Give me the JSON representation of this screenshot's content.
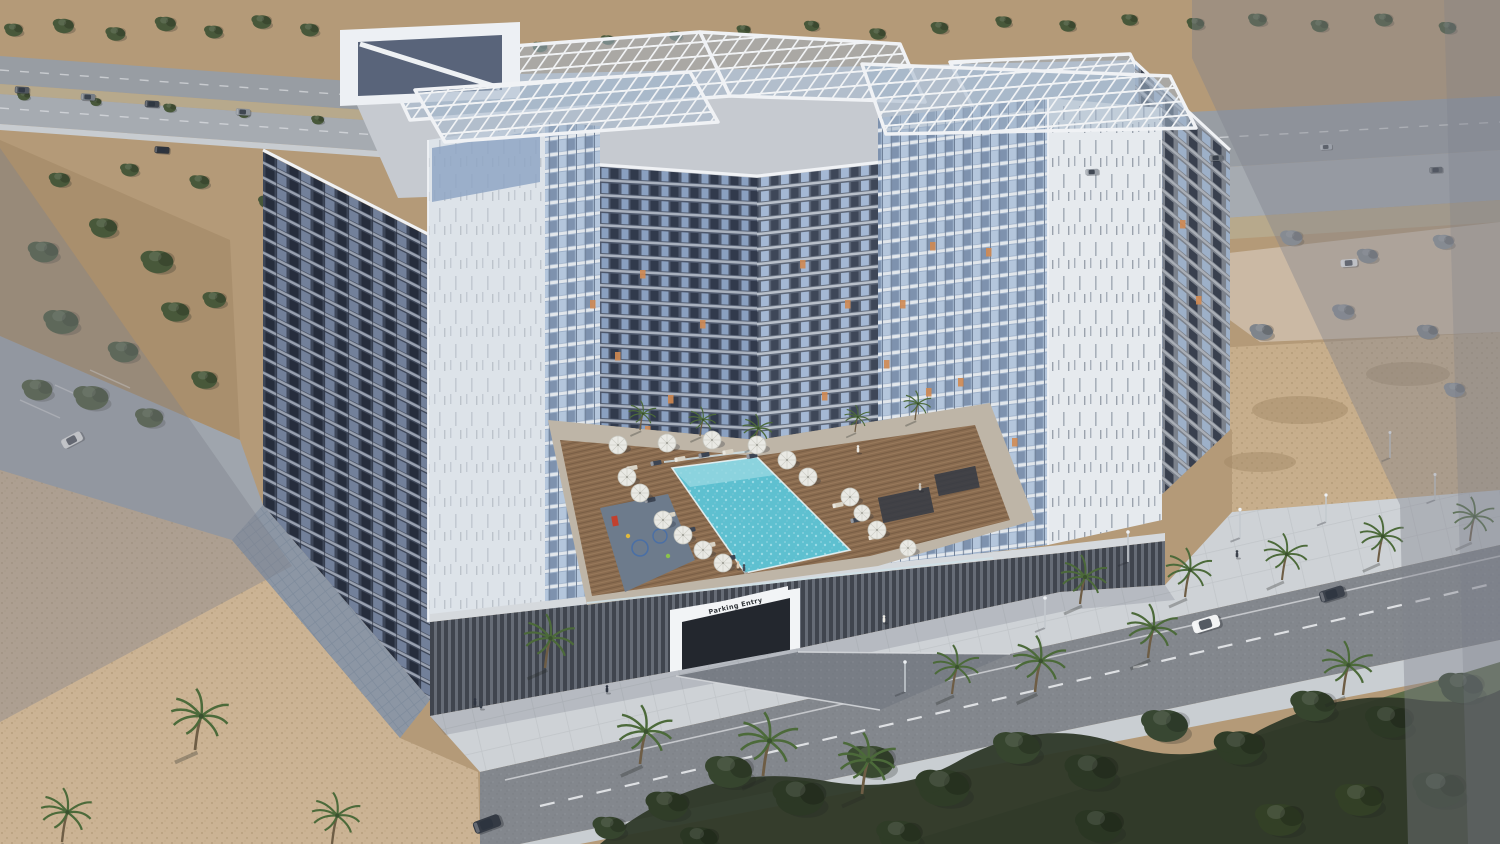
{
  "scene": {
    "type": "aerial architectural rendering",
    "setting": "U-shaped residential apartment complex with rooftop pergolas and a central pool courtyard, in a desert city with palm-lined streets",
    "labels": {
      "parking_sign": "Parking Entry"
    },
    "colors": {
      "dirt": "#b49a78",
      "dirtDark": "#a98f6d",
      "roadTop": "#989da3",
      "roadTop2": "#a6abb1",
      "median": "#b7a98c",
      "plaza": "#cbb9a4",
      "parkingLot": "#9fa5ad",
      "sandLeft": "#cbb394",
      "sandRight": "#c7ae8c",
      "sandStreak": "#a08764",
      "sidewalk": "#ced2d6",
      "stripWalk": "#c9ced2",
      "road": "#83878d",
      "laneLine": "#e8eaec",
      "grass": "#5c6d49",
      "foliage": "#2e3828",
      "poolWater": "#5ec0d0",
      "poolLight": "#93d6e0",
      "deckWood": "#8a6c50",
      "walkway": "#beb5a7",
      "playground": "#6d7b8c",
      "fence": "#cfe0e8",
      "louver": "#40454e",
      "coping": "#d5d9dd",
      "driveway": "#787d85",
      "tiledWalk": "#aab6c2",
      "towerWhite": "#dde3e9",
      "whitePanel": "#e6eaee",
      "roofSlab": "#c6cad0",
      "pergolaGlass": "#a3b4c8",
      "parapet": "#f0f2f5",
      "penthouseGlass": "#8fa6c4",
      "portalInner": "#59647a",
      "signBg": "#f2f4f6",
      "signText": "#2f3338",
      "entryDark": "#23272e",
      "treeGreen": "#48583a",
      "palmGreen": "#4c6a3a",
      "palmTrunk": "#6e5d45",
      "litWindow": "#d08a52",
      "overlay": "rgba(127,131,141,0.40)",
      "overlayEdge": "rgba(120,124,134,0.25)"
    }
  },
  "instances": {
    "bgTrees": [
      {
        "x": 14,
        "y": 30,
        "s": 0.8
      },
      {
        "x": 64,
        "y": 26,
        "s": 0.9
      },
      {
        "x": 116,
        "y": 34,
        "s": 0.85
      },
      {
        "x": 166,
        "y": 24,
        "s": 0.9
      },
      {
        "x": 214,
        "y": 32,
        "s": 0.8
      },
      {
        "x": 262,
        "y": 22,
        "s": 0.85
      },
      {
        "x": 310,
        "y": 30,
        "s": 0.8
      },
      {
        "x": 356,
        "y": 40,
        "s": 0.7
      },
      {
        "x": 404,
        "y": 46,
        "s": 0.75
      },
      {
        "x": 470,
        "y": 52,
        "s": 0.7
      },
      {
        "x": 540,
        "y": 47,
        "s": 0.65
      },
      {
        "x": 608,
        "y": 40,
        "s": 0.6
      },
      {
        "x": 676,
        "y": 36,
        "s": 0.6
      },
      {
        "x": 744,
        "y": 30,
        "s": 0.6
      },
      {
        "x": 812,
        "y": 26,
        "s": 0.65
      },
      {
        "x": 878,
        "y": 34,
        "s": 0.7
      },
      {
        "x": 940,
        "y": 28,
        "s": 0.75
      },
      {
        "x": 1004,
        "y": 22,
        "s": 0.7
      },
      {
        "x": 1068,
        "y": 26,
        "s": 0.7
      },
      {
        "x": 1130,
        "y": 20,
        "s": 0.7
      },
      {
        "x": 1196,
        "y": 24,
        "s": 0.75
      },
      {
        "x": 1258,
        "y": 20,
        "s": 0.8
      },
      {
        "x": 1320,
        "y": 26,
        "s": 0.75
      },
      {
        "x": 1384,
        "y": 20,
        "s": 0.8
      },
      {
        "x": 1448,
        "y": 28,
        "s": 0.75
      },
      {
        "x": 24,
        "y": 96,
        "s": 0.55
      },
      {
        "x": 96,
        "y": 102,
        "s": 0.5
      },
      {
        "x": 170,
        "y": 108,
        "s": 0.55
      },
      {
        "x": 244,
        "y": 114,
        "s": 0.5
      },
      {
        "x": 318,
        "y": 120,
        "s": 0.55
      },
      {
        "x": 392,
        "y": 126,
        "s": 0.5
      },
      {
        "x": 466,
        "y": 132,
        "s": 0.5
      },
      {
        "x": 44,
        "y": 252,
        "s": 1.3
      },
      {
        "x": 104,
        "y": 228,
        "s": 1.2
      },
      {
        "x": 158,
        "y": 262,
        "s": 1.4
      },
      {
        "x": 62,
        "y": 322,
        "s": 1.5
      },
      {
        "x": 124,
        "y": 352,
        "s": 1.3
      },
      {
        "x": 176,
        "y": 312,
        "s": 1.2
      },
      {
        "x": 92,
        "y": 398,
        "s": 1.5
      },
      {
        "x": 38,
        "y": 390,
        "s": 1.3
      },
      {
        "x": 150,
        "y": 418,
        "s": 1.2
      },
      {
        "x": 205,
        "y": 380,
        "s": 1.1
      },
      {
        "x": 215,
        "y": 300,
        "s": 1.0
      },
      {
        "x": 60,
        "y": 180,
        "s": 0.9
      },
      {
        "x": 130,
        "y": 170,
        "s": 0.8
      },
      {
        "x": 200,
        "y": 182,
        "s": 0.85
      },
      {
        "x": 268,
        "y": 202,
        "s": 0.8
      },
      {
        "x": 935,
        "y": 186,
        "s": 0.9,
        "c": "#6e7a62"
      },
      {
        "x": 1008,
        "y": 176,
        "s": 0.95,
        "c": "#67735c"
      },
      {
        "x": 1086,
        "y": 190,
        "s": 0.85,
        "c": "#6e7a62"
      },
      {
        "x": 520,
        "y": 130,
        "s": 0.6
      },
      {
        "x": 596,
        "y": 140,
        "s": 0.55
      },
      {
        "x": 660,
        "y": 150,
        "s": 0.5
      }
    ],
    "grayTrees": [
      {
        "x": 1215,
        "y": 252,
        "s": 0.9,
        "c": "#848a90"
      },
      {
        "x": 1292,
        "y": 238,
        "s": 0.95,
        "c": "#8b9197"
      },
      {
        "x": 1368,
        "y": 256,
        "s": 0.9,
        "c": "#848a90"
      },
      {
        "x": 1444,
        "y": 242,
        "s": 0.9,
        "c": "#8b9197"
      },
      {
        "x": 1262,
        "y": 332,
        "s": 1.0,
        "c": "#7f858c"
      },
      {
        "x": 1344,
        "y": 312,
        "s": 0.95,
        "c": "#878d94"
      },
      {
        "x": 1428,
        "y": 332,
        "s": 0.9,
        "c": "#7f858c"
      },
      {
        "x": 1180,
        "y": 300,
        "s": 0.85,
        "c": "#878d94"
      },
      {
        "x": 1455,
        "y": 390,
        "s": 0.9,
        "c": "#8a9096"
      }
    ],
    "foliageTrees": [
      {
        "x": 668,
        "y": 806,
        "s": 1.8,
        "c": "#303d28"
      },
      {
        "x": 730,
        "y": 772,
        "s": 2.0,
        "c": "#36452e"
      },
      {
        "x": 800,
        "y": 798,
        "s": 2.2,
        "c": "#2c3825"
      },
      {
        "x": 872,
        "y": 762,
        "s": 2.0,
        "c": "#3a4a31"
      },
      {
        "x": 944,
        "y": 788,
        "s": 2.3,
        "c": "#2f3c27"
      },
      {
        "x": 1018,
        "y": 748,
        "s": 2.0,
        "c": "#36452e"
      },
      {
        "x": 1092,
        "y": 772,
        "s": 2.2,
        "c": "#2c3825"
      },
      {
        "x": 1166,
        "y": 726,
        "s": 2.0,
        "c": "#384732"
      },
      {
        "x": 1240,
        "y": 748,
        "s": 2.1,
        "c": "#2f3c27"
      },
      {
        "x": 1314,
        "y": 706,
        "s": 1.9,
        "c": "#36452e"
      },
      {
        "x": 1390,
        "y": 722,
        "s": 2.0,
        "c": "#2c3825"
      },
      {
        "x": 1462,
        "y": 688,
        "s": 1.9,
        "c": "#384732"
      },
      {
        "x": 1440,
        "y": 790,
        "s": 2.2,
        "c": "#2a3623"
      },
      {
        "x": 1360,
        "y": 800,
        "s": 2.0,
        "c": "#334026"
      },
      {
        "x": 700,
        "y": 840,
        "s": 1.6,
        "c": "#2a3623"
      },
      {
        "x": 900,
        "y": 836,
        "s": 1.9,
        "c": "#2f3c27"
      },
      {
        "x": 1100,
        "y": 826,
        "s": 2.0,
        "c": "#2a3623"
      },
      {
        "x": 1280,
        "y": 820,
        "s": 2.0,
        "c": "#334026"
      },
      {
        "x": 610,
        "y": 828,
        "s": 1.4,
        "c": "#36452e"
      }
    ],
    "palms": [
      {
        "x": 545,
        "y": 668,
        "s": 1.1
      },
      {
        "x": 195,
        "y": 750,
        "s": 1.25
      },
      {
        "x": 62,
        "y": 842,
        "s": 1.1
      },
      {
        "x": 332,
        "y": 844,
        "s": 1.05
      },
      {
        "x": 640,
        "y": 764,
        "s": 1.2
      },
      {
        "x": 1080,
        "y": 604,
        "s": 1.0
      },
      {
        "x": 1185,
        "y": 597,
        "s": 1.0
      },
      {
        "x": 1282,
        "y": 580,
        "s": 0.95
      },
      {
        "x": 1378,
        "y": 562,
        "s": 0.95
      },
      {
        "x": 1470,
        "y": 541,
        "s": 0.9
      },
      {
        "x": 1035,
        "y": 692,
        "s": 1.15
      },
      {
        "x": 1148,
        "y": 658,
        "s": 1.1
      },
      {
        "x": 952,
        "y": 694,
        "s": 1.0
      },
      {
        "x": 763,
        "y": 776,
        "s": 1.3
      },
      {
        "x": 862,
        "y": 794,
        "s": 1.25
      },
      {
        "x": 1343,
        "y": 695,
        "s": 1.1
      }
    ],
    "courtPalms": [
      {
        "x": 640,
        "y": 430,
        "s": 0.6
      },
      {
        "x": 700,
        "y": 436,
        "s": 0.6
      },
      {
        "x": 755,
        "y": 446,
        "s": 0.65
      },
      {
        "x": 915,
        "y": 420,
        "s": 0.6
      },
      {
        "x": 855,
        "y": 432,
        "s": 0.55
      }
    ],
    "poles": [
      {
        "x": 1045,
        "y": 628,
        "s": 1
      },
      {
        "x": 1128,
        "y": 562,
        "s": 1
      },
      {
        "x": 1240,
        "y": 538,
        "s": 0.95
      },
      {
        "x": 1326,
        "y": 522,
        "s": 0.9
      },
      {
        "x": 1390,
        "y": 458,
        "s": 0.85
      },
      {
        "x": 905,
        "y": 692,
        "s": 1
      },
      {
        "x": 1435,
        "y": 500,
        "s": 0.85
      }
    ],
    "cars": [
      {
        "x": 1206,
        "y": 624,
        "r": -17,
        "s": 1.15,
        "c": "#f2f3f4"
      },
      {
        "x": 1332,
        "y": 594,
        "r": -17,
        "s": 1.05,
        "c": "#3c424c"
      },
      {
        "x": 487,
        "y": 824,
        "r": -20,
        "s": 1.15,
        "c": "#343a44"
      },
      {
        "x": 1349,
        "y": 263,
        "r": -4,
        "s": 0.7,
        "c": "#e8eaec"
      },
      {
        "x": 72,
        "y": 440,
        "r": -28,
        "s": 0.9,
        "c": "#e9ebec"
      },
      {
        "x": 22,
        "y": 90,
        "r": 3,
        "s": 0.6,
        "c": "#51575f"
      },
      {
        "x": 88,
        "y": 97,
        "r": 3,
        "s": 0.6,
        "c": "#777d85"
      },
      {
        "x": 152,
        "y": 104,
        "r": 3,
        "s": 0.6,
        "c": "#3f454e"
      },
      {
        "x": 243,
        "y": 112,
        "r": 3,
        "s": 0.6,
        "c": "#8a9098"
      },
      {
        "x": 162,
        "y": 150,
        "r": 4,
        "s": 0.62,
        "c": "#2f343c"
      },
      {
        "x": 1092,
        "y": 172,
        "r": -3,
        "s": 0.55,
        "c": "#9aa0a8"
      },
      {
        "x": 1216,
        "y": 158,
        "r": -3,
        "s": 0.55,
        "c": "#6b7179"
      },
      {
        "x": 1326,
        "y": 147,
        "r": -3,
        "s": 0.5,
        "c": "#aeb4bc"
      },
      {
        "x": 1436,
        "y": 170,
        "r": -3,
        "s": 0.55,
        "c": "#565c64"
      }
    ],
    "umbrellas": [
      {
        "x": 618,
        "y": 445
      },
      {
        "x": 667,
        "y": 443
      },
      {
        "x": 712,
        "y": 440
      },
      {
        "x": 757,
        "y": 445
      },
      {
        "x": 787,
        "y": 460
      },
      {
        "x": 808,
        "y": 477
      },
      {
        "x": 850,
        "y": 497
      },
      {
        "x": 862,
        "y": 513,
        "s": 0.9
      },
      {
        "x": 877,
        "y": 530
      },
      {
        "x": 627,
        "y": 477
      },
      {
        "x": 640,
        "y": 493
      },
      {
        "x": 663,
        "y": 520
      },
      {
        "x": 683,
        "y": 535
      },
      {
        "x": 703,
        "y": 550
      },
      {
        "x": 723,
        "y": 563
      },
      {
        "x": 908,
        "y": 548,
        "s": 0.9
      }
    ],
    "loungers": [
      {
        "x": 632,
        "y": 468,
        "r": -10,
        "c": "#d9d3c5"
      },
      {
        "x": 656,
        "y": 463,
        "r": -10,
        "c": "#3c4452"
      },
      {
        "x": 680,
        "y": 459,
        "r": -10,
        "c": "#d9d3c5"
      },
      {
        "x": 704,
        "y": 455,
        "r": -10,
        "c": "#3c4452"
      },
      {
        "x": 728,
        "y": 452,
        "r": -10,
        "c": "#d9d3c5"
      },
      {
        "x": 752,
        "y": 456,
        "r": -10,
        "c": "#3c4452"
      },
      {
        "x": 650,
        "y": 500,
        "r": -12,
        "c": "#3c4452"
      },
      {
        "x": 670,
        "y": 515,
        "r": -12,
        "c": "#d9d3c5"
      },
      {
        "x": 690,
        "y": 530,
        "r": -12,
        "c": "#3c4452"
      },
      {
        "x": 710,
        "y": 545,
        "r": -12,
        "c": "#d9d3c5"
      },
      {
        "x": 730,
        "y": 558,
        "r": -12,
        "c": "#3c4452"
      },
      {
        "x": 838,
        "y": 505,
        "r": -12,
        "c": "#d9d3c5"
      },
      {
        "x": 856,
        "y": 520,
        "r": -12,
        "c": "#3c4452"
      },
      {
        "x": 874,
        "y": 537,
        "r": -12,
        "c": "#d9d3c5"
      }
    ],
    "people": [
      {
        "x": 858,
        "y": 452,
        "c": "#eae8e2"
      },
      {
        "x": 884,
        "y": 622,
        "c": "#eceae4"
      },
      {
        "x": 607,
        "y": 692,
        "c": "#2e3440"
      },
      {
        "x": 475,
        "y": 705,
        "c": "#2e3440"
      },
      {
        "x": 481,
        "y": 708,
        "c": "#3a414c"
      },
      {
        "x": 738,
        "y": 568,
        "c": "#d9c8b2"
      },
      {
        "x": 744,
        "y": 571,
        "c": "#454d58"
      },
      {
        "x": 1237,
        "y": 557,
        "c": "#3c424c"
      },
      {
        "x": 920,
        "y": 490,
        "c": "#c9c4ba"
      }
    ],
    "litWindows": [
      {
        "x": 590,
        "y": 300
      },
      {
        "x": 615,
        "y": 352
      },
      {
        "x": 640,
        "y": 270
      },
      {
        "x": 668,
        "y": 395
      },
      {
        "x": 700,
        "y": 320
      },
      {
        "x": 645,
        "y": 426
      },
      {
        "x": 800,
        "y": 260
      },
      {
        "x": 845,
        "y": 300
      },
      {
        "x": 884,
        "y": 360
      },
      {
        "x": 930,
        "y": 242
      },
      {
        "x": 958,
        "y": 378
      },
      {
        "x": 822,
        "y": 392
      },
      {
        "x": 900,
        "y": 300
      },
      {
        "x": 926,
        "y": 388
      },
      {
        "x": 986,
        "y": 248
      },
      {
        "x": 1012,
        "y": 438
      },
      {
        "x": 952,
        "y": 468
      },
      {
        "x": 1180,
        "y": 220
      },
      {
        "x": 1196,
        "y": 296
      }
    ]
  }
}
